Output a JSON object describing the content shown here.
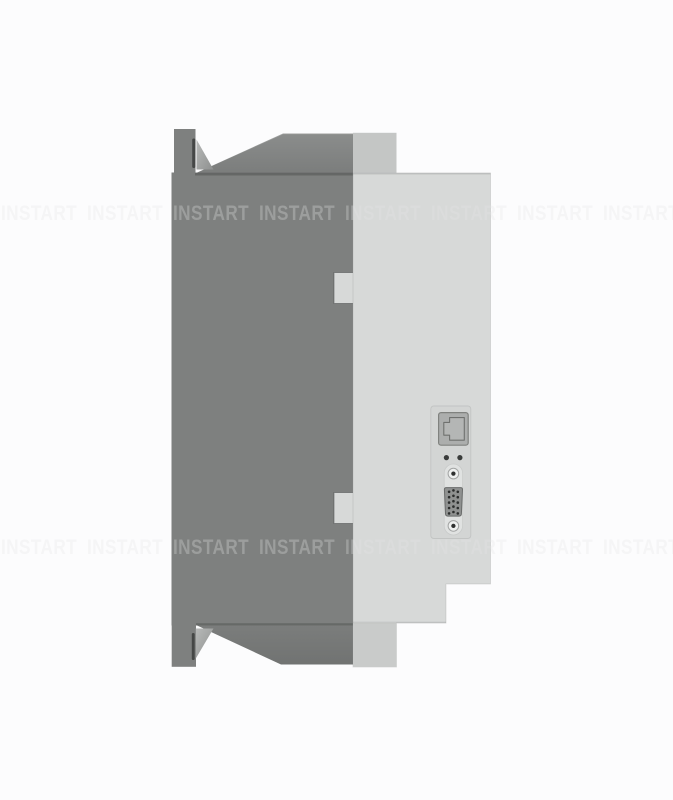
{
  "page": {
    "kind": "product-photo"
  },
  "watermark": {
    "text": "INSTART",
    "words_per_row": 8,
    "row_tops_px": [
      200,
      534
    ]
  },
  "device": {
    "chassis_icon": "heatsink-chassis-side",
    "cover_icon": "front-cover-side",
    "features": [
      {
        "icon": "mounting-flange-icon",
        "position": "top"
      },
      {
        "icon": "keyhole-slot-icon",
        "position": "top"
      },
      {
        "icon": "mounting-flange-icon",
        "position": "bottom"
      },
      {
        "icon": "keyhole-slot-icon",
        "position": "bottom"
      },
      {
        "icon": "cover-clip-tab-icon",
        "position": "upper-left"
      },
      {
        "icon": "cover-clip-tab-icon",
        "position": "lower-left"
      },
      {
        "icon": "rj45-port-icon",
        "position": "connector-panel"
      },
      {
        "icon": "indicator-dot-icon",
        "count": 2
      },
      {
        "icon": "d-sub-connector-icon",
        "pins": 15,
        "screws": 2
      }
    ]
  },
  "colors": {
    "bg": "#fcfcfd",
    "chassis": "#7e807f",
    "roofTop": "#8b8d8c",
    "roofBot": "#7b7d7c",
    "slopeTop": "#7b7d7c",
    "slopeBot": "#717372",
    "cover": "#d7d9d8",
    "coverOverlapTop": "#c4c6c5",
    "coverOverlapBottom": "#c9cbca",
    "gussetLight": "#b7b9b8",
    "gussetDark": "#8e908f",
    "slot": "#454746",
    "panel": "#d3d5d4",
    "panelBorder": "#c2c4c3",
    "jack": "#acaead",
    "jackBorder": "#80827f",
    "jackInner": "#b4b6b5",
    "jackInnerBorder": "#6f716f",
    "dot": "#3a3c3b",
    "backplate": "#e2e4e3",
    "backplateBorder": "#c8cac9",
    "screwOuter": "#eef0ef",
    "screwBorder": "#a3a5a4",
    "screwCenter": "#2e302f",
    "dsubBody": "#8f9190",
    "dsubBorder": "#6a6c6b",
    "pin": "#2b2d2c",
    "wmLight": "rgba(255,255,255,0.26)",
    "wmDark": "rgba(55,57,56,0.052)"
  }
}
